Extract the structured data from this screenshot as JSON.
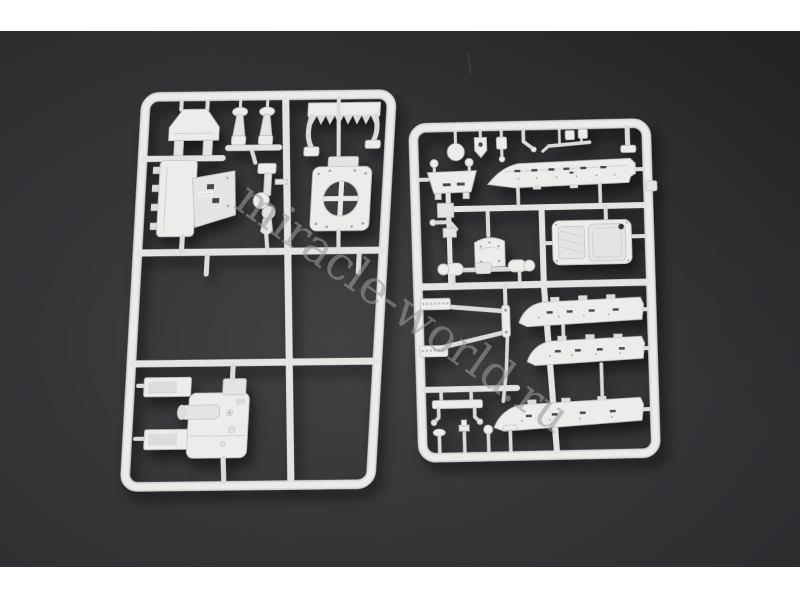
{
  "page": {
    "title": "Plastic model kit sprues — product photo"
  },
  "photo": {
    "backdrop_color_center": "#414144",
    "backdrop_color_edge": "#2a2a2d",
    "plastic_color": "#e6e6e4",
    "top_band_color": "#ffffff",
    "bottom_band_color": "#ffffff",
    "watermark": {
      "text": "miracle-world.ru",
      "color": "#9b9b9e",
      "opacity": "0.58",
      "angle_deg": "35.3"
    },
    "sprues": [
      {
        "id": "left-sprue",
        "parts": [
          "a-frame-bracket",
          "mushroom-knob-1",
          "mushroom-knob-2",
          "toothed-grille-plate",
          "superstructure-block",
          "periscope-cluster",
          "hatch-ring-plate",
          "gun-mount-block"
        ]
      },
      {
        "id": "right-sprue",
        "parts": [
          "round-disc",
          "tool-clamp-1",
          "tool-clamp-2",
          "bent-rod",
          "rod-tool",
          "mini-clamps",
          "end-bar",
          "hull-side-panel",
          "floor-pan-bracket",
          "exhaust-elbow",
          "trapezoid-bracket",
          "axle-shaft",
          "gearbox-housing",
          "tow-bar",
          "side-skirt-1",
          "side-skirt-2",
          "side-skirt-3",
          "tow-bench",
          "mushroom-pin-1",
          "mushroom-pin-2",
          "mushroom-pin-3",
          "mushroom-pin-4"
        ]
      }
    ]
  }
}
